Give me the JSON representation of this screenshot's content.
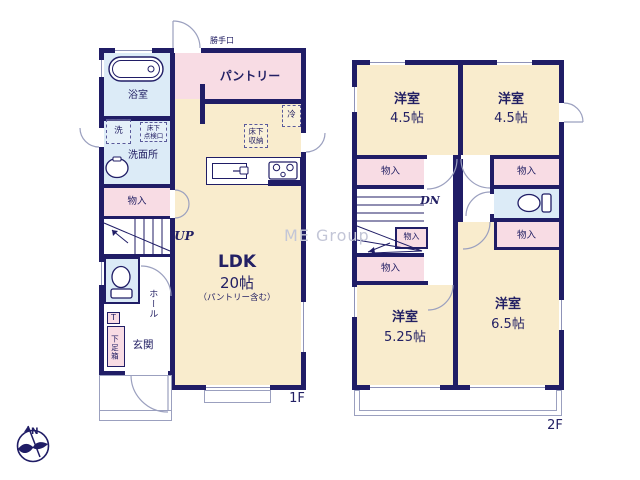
{
  "watermark": "ME Group",
  "compass": {
    "north": "N"
  },
  "colors": {
    "wall_navy": "#201d66",
    "floor_cream": "#f9eccd",
    "closet_pink": "#f8dce4",
    "wet_area_blue": "#dcebf7",
    "door_line_gray": "#9ba0bf",
    "text_navy": "#232064",
    "watermark_gray": "#c3c6d7"
  },
  "floor1": {
    "label": "1F",
    "back_door": "勝手口",
    "pantry": "パントリー",
    "bathroom": "浴室",
    "laundry": "洗",
    "underfloor_inspection": "床下\n点検口",
    "washroom": "洗面所",
    "storage": "物入",
    "refrigerator": "冷",
    "underfloor_storage": "床下\n収納",
    "ldk_name": "LDK",
    "ldk_size": "20帖",
    "ldk_note": "（パントリー含む）",
    "stairs_up": "UP",
    "hall": "ホール",
    "shoe_mark": "T",
    "shoe_cabinet": "下足箱",
    "entrance": "玄関"
  },
  "floor2": {
    "label": "2F",
    "stairs_down": "DN",
    "room_type": "洋室",
    "room_nw_size": "4.5帖",
    "room_ne_size": "4.5帖",
    "room_sw_size": "5.25帖",
    "room_se_size": "6.5帖",
    "storage": "物入"
  }
}
